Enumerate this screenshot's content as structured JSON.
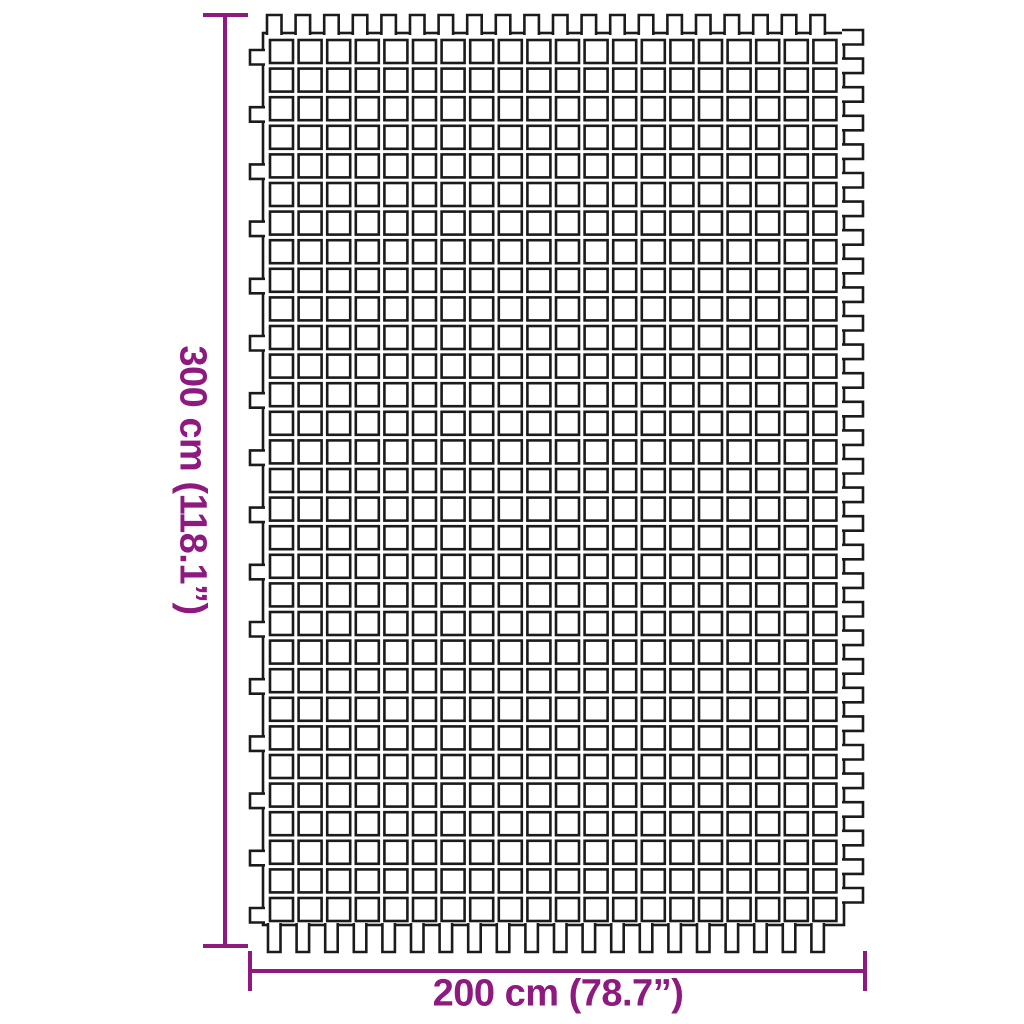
{
  "dimensions": {
    "height_label": "300 cm (118.1”)",
    "width_label": "200 cm (78.7”)",
    "accent_color": "#8e1a80"
  },
  "figure": {
    "type": "mesh-ground-mat",
    "outline_color": "#1b1b1b",
    "background_color": "#ffffff",
    "stroke_width": 2.6,
    "border": {
      "x": 263,
      "y": 33,
      "width": 581,
      "height": 892
    },
    "squares": {
      "cols": 20,
      "rows": 31,
      "size": 23,
      "pitch": 28.6,
      "start_x": 270,
      "start_y": 40
    },
    "tabs": {
      "top": {
        "start": 267,
        "pitch": 28.6,
        "count": 20,
        "depth": 18,
        "width": 14.5
      },
      "bottom": {
        "start": 268,
        "pitch": 28.6,
        "count": 20,
        "depth": 27,
        "width": 12.5
      },
      "left": {
        "start": 50,
        "pitch": 57.2,
        "count": 16,
        "depth": 13,
        "width": 14.5
      },
      "right": {
        "start": 30,
        "pitch": 28.6,
        "count": 31,
        "depth": 19,
        "width": 14.5
      }
    }
  }
}
